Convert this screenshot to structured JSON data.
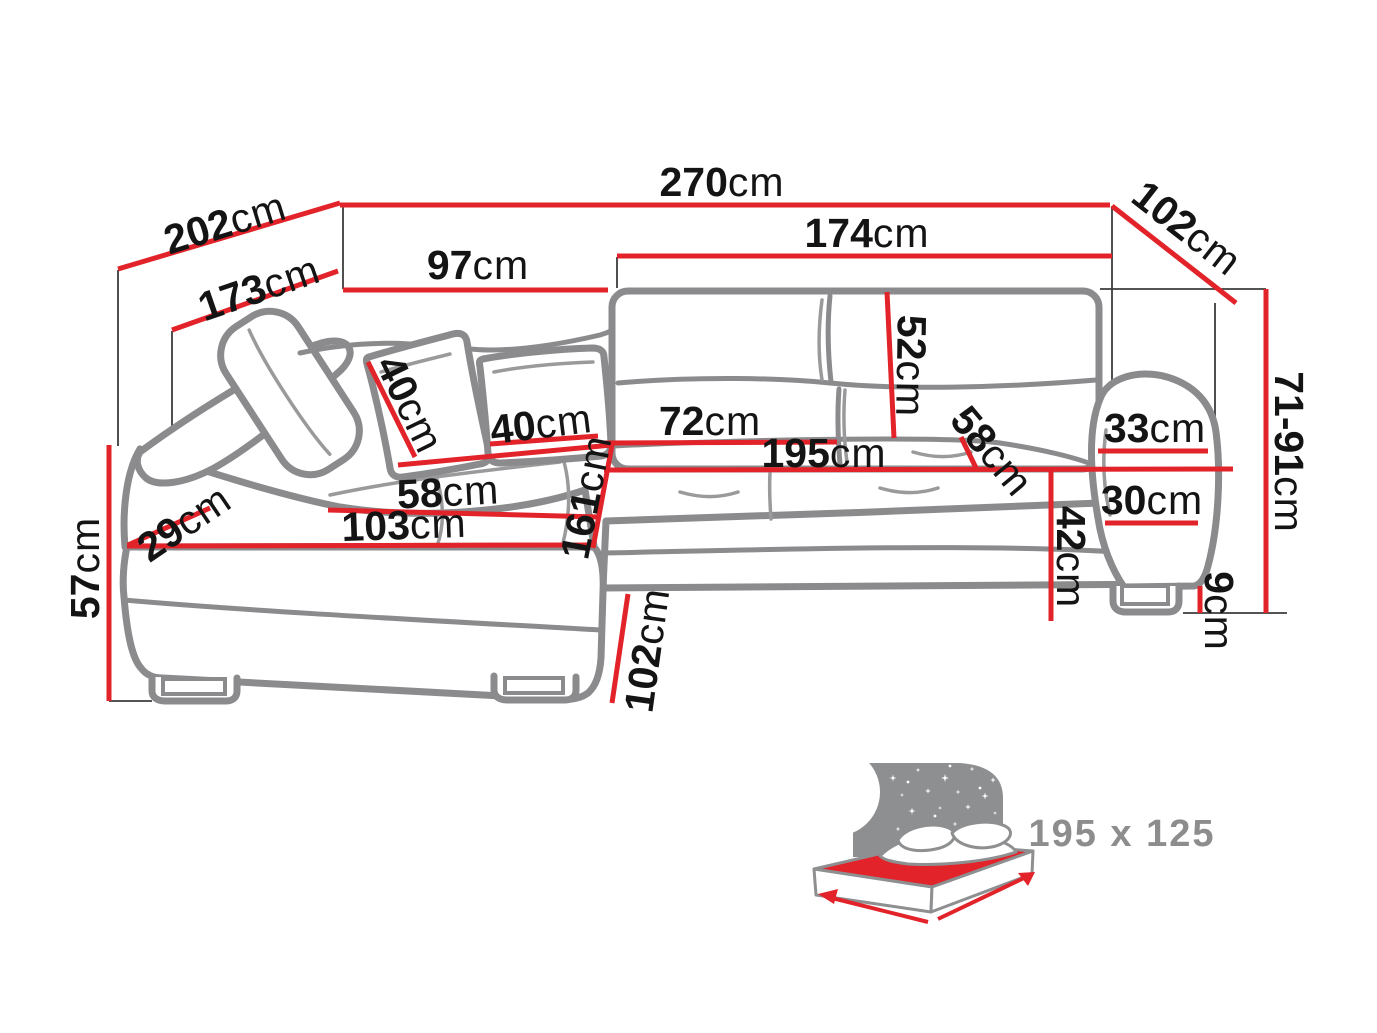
{
  "diagram": {
    "type": "corner-sofa-dimension-diagram",
    "unit": "cm",
    "colors": {
      "dimension_line": "#e2232a",
      "sofa_outline": "#8b8b8d",
      "label_text": "#141414",
      "bed_label_text": "#8d8d8d"
    },
    "dims": {
      "d202": {
        "value": "202",
        "unit": "cm"
      },
      "d173": {
        "value": "173",
        "unit": "cm"
      },
      "d270": {
        "value": "270",
        "unit": "cm"
      },
      "d97": {
        "value": "97",
        "unit": "cm"
      },
      "d174": {
        "value": "174",
        "unit": "cm"
      },
      "d102_top": {
        "value": "102",
        "unit": "cm"
      },
      "d52": {
        "value": "52",
        "unit": "cm"
      },
      "d40_pillow_left": {
        "value": "40",
        "unit": "cm"
      },
      "d40_pillow_right": {
        "value": "40",
        "unit": "cm"
      },
      "d72": {
        "value": "72",
        "unit": "cm"
      },
      "d195": {
        "value": "195",
        "unit": "cm"
      },
      "d58_seat_right": {
        "value": "58",
        "unit": "cm"
      },
      "d33": {
        "value": "33",
        "unit": "cm"
      },
      "d30": {
        "value": "30",
        "unit": "cm"
      },
      "d42": {
        "value": "42",
        "unit": "cm"
      },
      "d9": {
        "value": "9",
        "unit": "cm"
      },
      "d71_91": {
        "value": "71-91",
        "unit": "cm"
      },
      "d57": {
        "value": "57",
        "unit": "cm"
      },
      "d29": {
        "value": "29",
        "unit": "cm"
      },
      "d58_seat_left": {
        "value": "58",
        "unit": "cm"
      },
      "d103": {
        "value": "103",
        "unit": "cm"
      },
      "d161": {
        "value": "161",
        "unit": "cm"
      },
      "d102_bottom": {
        "value": "102",
        "unit": "cm"
      }
    },
    "bed": {
      "size_label": "195 x 125"
    }
  }
}
